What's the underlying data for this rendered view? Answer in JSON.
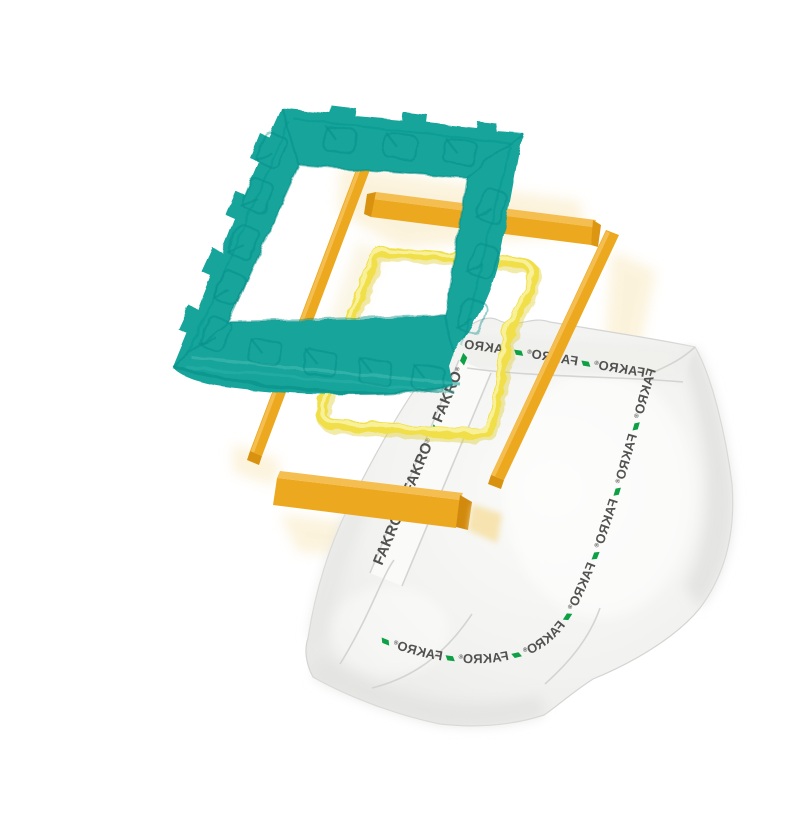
{
  "meta": {
    "background": "#ffffff"
  },
  "branding": {
    "wordmark": "FAKRO",
    "registered_mark": "®",
    "separator_glyph": "▰",
    "wordmark_color": "#3a3a38",
    "accent_green": "#009b3b",
    "stripes": [
      {
        "id": "left-strip",
        "mirrored": false,
        "repeats": 4
      },
      {
        "id": "top-fold",
        "mirrored": true,
        "repeats": 3
      },
      {
        "id": "right-edge",
        "mirrored": true,
        "repeats": 7
      }
    ]
  },
  "parts": [
    {
      "id": "flashing-collar",
      "label": "flashing collar frame",
      "color": "#12a49b",
      "shadow": "#0b8a82",
      "highlight": "#3db6ad"
    },
    {
      "id": "battens",
      "label": "mounting battens",
      "count": 4,
      "color": "#eca81f",
      "highlight": "#f5be50",
      "shadow": "#d8920f",
      "pale_glow": "#f8e7ba"
    },
    {
      "id": "foam-seal",
      "label": "foam sealing frame",
      "color": "#f0df49",
      "highlight": "#faf3a3",
      "shadow": "#decb2b"
    },
    {
      "id": "package",
      "label": "printed film package",
      "color": "#f2f2f0",
      "shadow": "#dededc",
      "edge": "#d4d4d2"
    }
  ]
}
